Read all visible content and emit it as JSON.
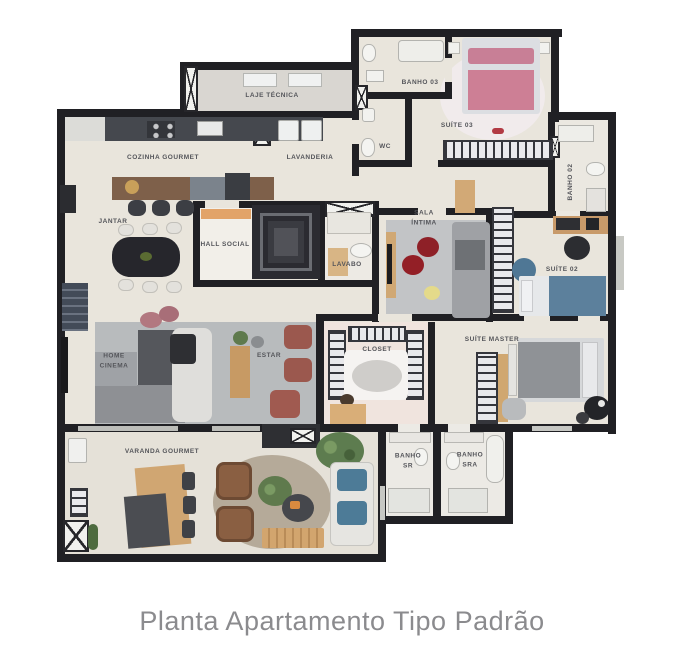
{
  "title": "Planta Apartamento Tipo Padrão",
  "plan": {
    "rooms": [
      {
        "id": "laje-tecnica",
        "label": "LAJE TÉCNICA"
      },
      {
        "id": "cozinha-gourmet",
        "label": "COZINHA GOURMET"
      },
      {
        "id": "lavanderia",
        "label": "LAVANDERIA"
      },
      {
        "id": "jantar",
        "label": "JANTAR"
      },
      {
        "id": "hall-social",
        "label": "HALL SOCIAL"
      },
      {
        "id": "lavabo",
        "label": "LAVABO"
      },
      {
        "id": "wc",
        "label": "WC"
      },
      {
        "id": "banho-03",
        "label": "BANHO 03"
      },
      {
        "id": "suite-03",
        "label": "SUÍTE 03"
      },
      {
        "id": "banho-02",
        "label": "BANHO 02"
      },
      {
        "id": "sala-intima",
        "label": "SALA\nÍNTIMA"
      },
      {
        "id": "suite-02",
        "label": "SUÍTE 02"
      },
      {
        "id": "home-cinema",
        "label": "HOME\nCINEMA"
      },
      {
        "id": "estar",
        "label": "ESTAR"
      },
      {
        "id": "closet",
        "label": "CLOSET"
      },
      {
        "id": "suite-master",
        "label": "SUÍTE MASTER"
      },
      {
        "id": "banho-sr",
        "label": "BANHO\nSR"
      },
      {
        "id": "banho-sra",
        "label": "BANHO\nSRA"
      },
      {
        "id": "varanda-gourmet",
        "label": "VARANDA GOURMET"
      }
    ],
    "colors": {
      "wall": "#202024",
      "floor": "#e9e5dc",
      "laje_floor": "#d9d6d1",
      "rug_gray": "#b8bbbd",
      "bed_pink": "#cd7f95",
      "bed_blue": "#5c809c",
      "bed_gray": "#8f9296",
      "pouf_red": "#8e2027",
      "armchair_terracotta": "#9b584e",
      "wood": "#d0a672",
      "counter_dark": "#45484e",
      "doormat_orange": "#e2a368",
      "plant_green": "#5d7c4f",
      "title_text": "#8b8b8e"
    }
  }
}
